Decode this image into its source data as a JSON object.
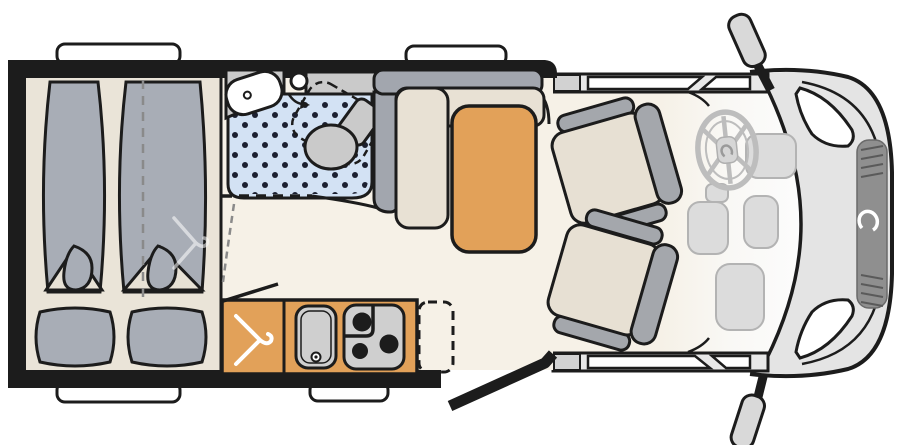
{
  "diagram": {
    "type": "campervan-floorplan",
    "regions": [
      "twin-beds",
      "washroom-shower",
      "swivel-toilet",
      "washbasin",
      "wardrobe",
      "kitchen-block",
      "dinette-with-table",
      "entry-door",
      "cab-with-swivel-seats",
      "steering-wheel",
      "vehicle-front"
    ]
  },
  "icons": {
    "wardrobe": "clothes-hanger-icon",
    "bed_watermark": "clothes-hanger-icon",
    "brand": "dethleffs-swoosh-icon"
  },
  "colors": {
    "outline": "#1c1c1c",
    "white": "#ffffff",
    "floor": "#f6f1e7",
    "bed_base": "#eae4d8",
    "mattress": "#a8adb6",
    "fold_wedge": "#e7e1d5",
    "unit_gray": "#cacaca",
    "shower": "#d3e2f4",
    "dot": "#1c2030",
    "wall_gray": "#a2a6ae",
    "bench": "#e8e1d4",
    "orange": "#e2a159",
    "appliance": "#cfcfcf",
    "burner": "#1c1c1c",
    "seat_cushion": "#e7e0d3",
    "seat_gray": "#a4a7ac",
    "cab_band": "#e8e8e8",
    "pillar_gray": "#d2d2d2",
    "hood": "#e4e4e4",
    "grille": "#8f8f8f",
    "grille_line": "#5a5a5a",
    "dash_blob": "#dcdcdc",
    "dash_blob_line": "#b3b3b3",
    "wheel_gray": "#bdbdbd",
    "hub_gray": "#d6d6d6",
    "mirror": "#d9d9d9",
    "logo": "#ffffff",
    "watermark": "rgba(255,255,255,0.55)",
    "dash_line_gray": "#8a8a8a"
  }
}
